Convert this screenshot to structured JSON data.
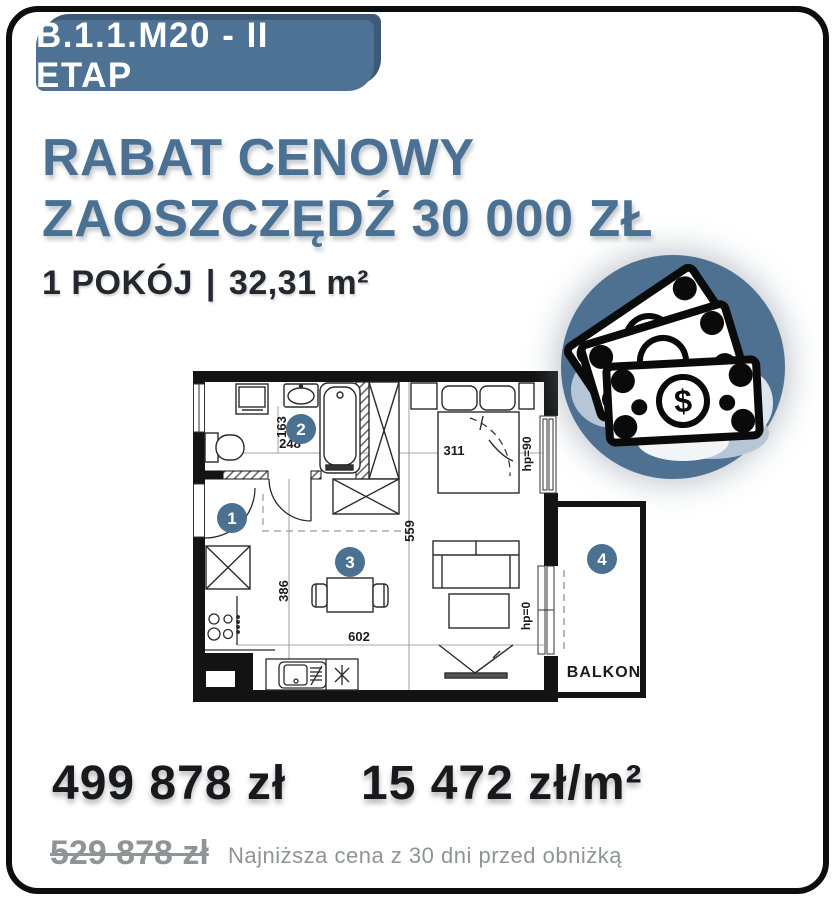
{
  "badge": {
    "label": "B.1.1.M20 - II ETAP"
  },
  "headline": {
    "line1": "RABAT CENOWY",
    "line2": "ZAOSZCZĘDŹ 30 000 ZŁ"
  },
  "unit_info": {
    "rooms": "1 POKÓJ",
    "separator": "|",
    "area": "32,31 m²"
  },
  "floorplan": {
    "rooms": [
      {
        "number": "1"
      },
      {
        "number": "2"
      },
      {
        "number": "3"
      },
      {
        "number": "4"
      }
    ],
    "labels": {
      "l163": "163",
      "l248": "248",
      "l311": "311",
      "l559": "559",
      "l386": "386",
      "l602": "602",
      "hp90": "hp=90",
      "hp0": "hp=0",
      "balcony": "BALKON"
    }
  },
  "icons": {
    "money": "money-banknotes-icon",
    "money_symbol": "$"
  },
  "pricing": {
    "current_price": "499 878 zł",
    "price_per_m2": "15 472 zł/m²",
    "previous_price": "529 878 zł",
    "disclaimer": "Najniższa cena z 30 dni przed obniżką"
  },
  "colors": {
    "accent_blue": "#4a7191",
    "accent_blue_dark": "#3c5a77",
    "headline_blue": "#4a7094",
    "text_dark": "#17191d",
    "text_gray": "#8f9497",
    "frame_black": "#0d0d0d"
  }
}
